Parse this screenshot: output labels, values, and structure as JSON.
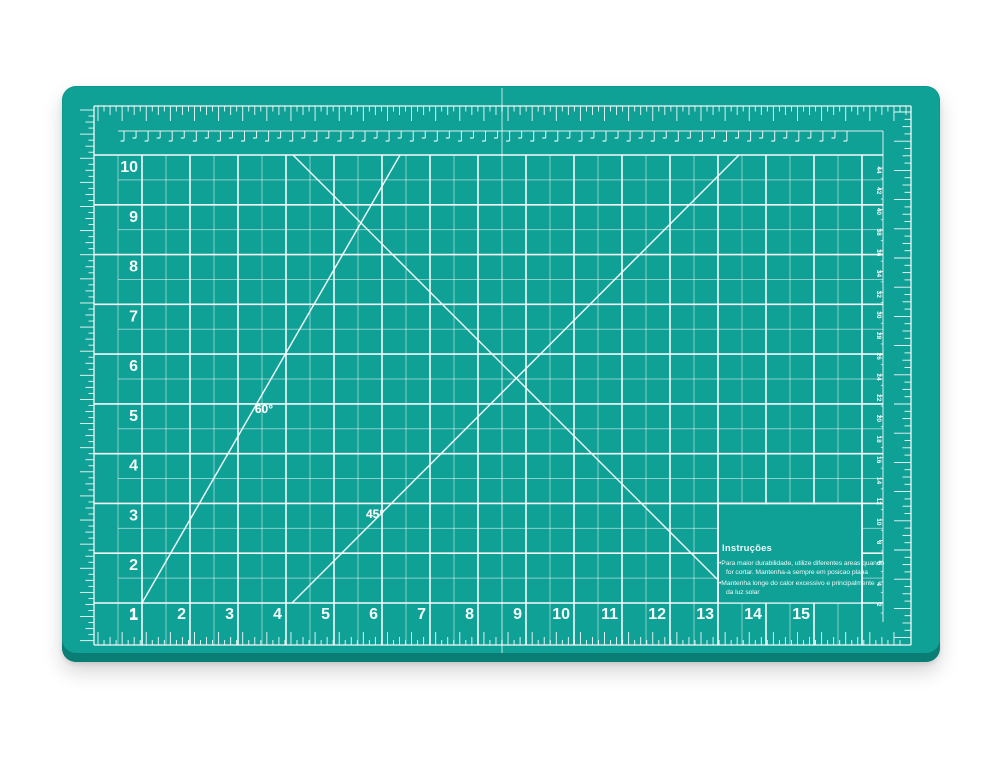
{
  "scene": {
    "description": "Teal self-healing cutting mat with white measuring grid, photographed on a white background"
  },
  "colors": {
    "mat": "#0fa096",
    "mat_dark_edge": "#0a7d75",
    "line": "#ffffff",
    "background": "#ffffff"
  },
  "grid": {
    "bottom_labels": [
      "1",
      "2",
      "3",
      "4",
      "5",
      "6",
      "7",
      "8",
      "9",
      "10",
      "11",
      "12",
      "13",
      "14",
      "15"
    ],
    "left_labels": [
      "1",
      "2",
      "3",
      "4",
      "5",
      "6",
      "7",
      "8",
      "9",
      "10"
    ]
  },
  "angle_labels": {
    "deg60": "60°",
    "deg45": "45°"
  },
  "side_ruler": {
    "numbers": [
      "44",
      "42",
      "40",
      "38",
      "36",
      "34",
      "32",
      "30",
      "28",
      "26",
      "24",
      "22",
      "20",
      "18",
      "16",
      "14",
      "12",
      "10",
      "8",
      "6",
      "4",
      "2"
    ]
  },
  "instructions": {
    "title": "Instruções",
    "line1": "•Para maior durabilidade, utilize diferentes areas quando",
    "line2": "for cortar. Mantenha-a sempre em posicao plana",
    "line3": "•Mantenha longe do calor excessivo e principalmente",
    "line4": "da luz solar"
  }
}
